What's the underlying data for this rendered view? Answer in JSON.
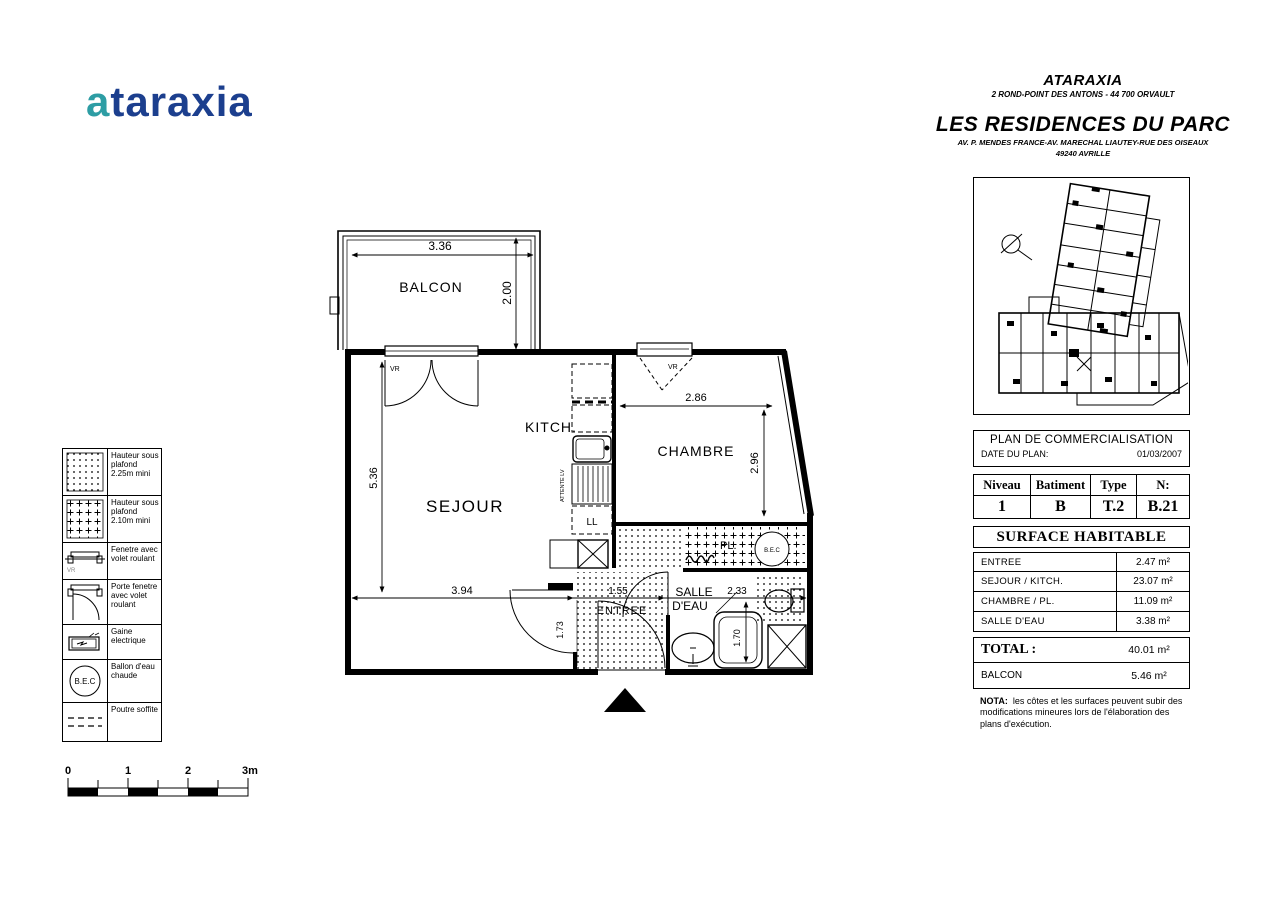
{
  "logo": {
    "accent": "a",
    "rest": "taraxia"
  },
  "header": {
    "company": "ATARAXIA",
    "company_address": "2 ROND-POINT DES ANTONS - 44 700 ORVAULT",
    "project": "LES RESIDENCES DU PARC",
    "project_address": "AV. P. MENDES FRANCE-AV. MARECHAL LIAUTEY-RUE DES OISEAUX",
    "project_city": "49240 AVRILLE"
  },
  "plan_info": {
    "title": "PLAN DE COMMERCIALISATION",
    "date_label": "DATE DU PLAN:",
    "date_value": "01/03/2007"
  },
  "unit_table": {
    "headers": [
      "Niveau",
      "Batiment",
      "Type",
      "N:"
    ],
    "values": [
      "1",
      "B",
      "T.2",
      "B.21"
    ]
  },
  "surface_table": {
    "title": "SURFACE HABITABLE",
    "rows": [
      {
        "label": "ENTREE",
        "value": "2.47 m²"
      },
      {
        "label": "SEJOUR / KITCH.",
        "value": "23.07 m²"
      },
      {
        "label": "CHAMBRE / PL.",
        "value": "11.09 m²"
      },
      {
        "label": "SALLE D'EAU",
        "value": "3.38 m²"
      }
    ],
    "total_label": "TOTAL    :",
    "total_value": "40.01 m²",
    "balcon_label": "BALCON",
    "balcon_value": "5.46 m²"
  },
  "nota": {
    "label": "NOTA:",
    "text": "les côtes et les surfaces peuvent subir des modifications mineures lors de l'élaboration des plans d'exécution."
  },
  "legend": {
    "items": [
      {
        "label": "Hauteur sous plafond 2.25m mini"
      },
      {
        "label": "Hauteur sous plafond 2.10m mini"
      },
      {
        "label": "Fenetre avec volet roulant"
      },
      {
        "label": "Porte fenetre avec volet roulant"
      },
      {
        "label": "Gaine electrique"
      },
      {
        "label": "Ballon d'eau chaude"
      },
      {
        "label": "Poutre soffite"
      }
    ],
    "bec_text": "B.E.C",
    "vr_text": "VR"
  },
  "scale_bar": {
    "labels": [
      "0",
      "1",
      "2",
      "3m"
    ]
  },
  "floor_plan": {
    "rooms": {
      "balcon": "BALCON",
      "sejour": "SEJOUR",
      "kitch": "KITCH.",
      "chambre": "CHAMBRE",
      "salle1": "SALLE",
      "salle2": "D'EAU",
      "entree": "ENTREE",
      "pl": "PL."
    },
    "dimensions": {
      "balcon_w": "3.36",
      "balcon_h": "2.00",
      "sejour_h": "5.36",
      "sejour_w": "3.94",
      "entree_w": "1.55",
      "entree_h": "1.73",
      "salle_w": "2.33",
      "chambre_w": "2.86",
      "chambre_h": "2.96",
      "douche_h": "1.70"
    },
    "annotations": {
      "vr": "VR",
      "ll": "LL",
      "attente_lv": "ATTENTE LV",
      "bec": "B.E.C"
    }
  },
  "colors": {
    "logo_accent": "#2d9da4",
    "logo_main": "#1c3f8e",
    "ink": "#000000"
  }
}
